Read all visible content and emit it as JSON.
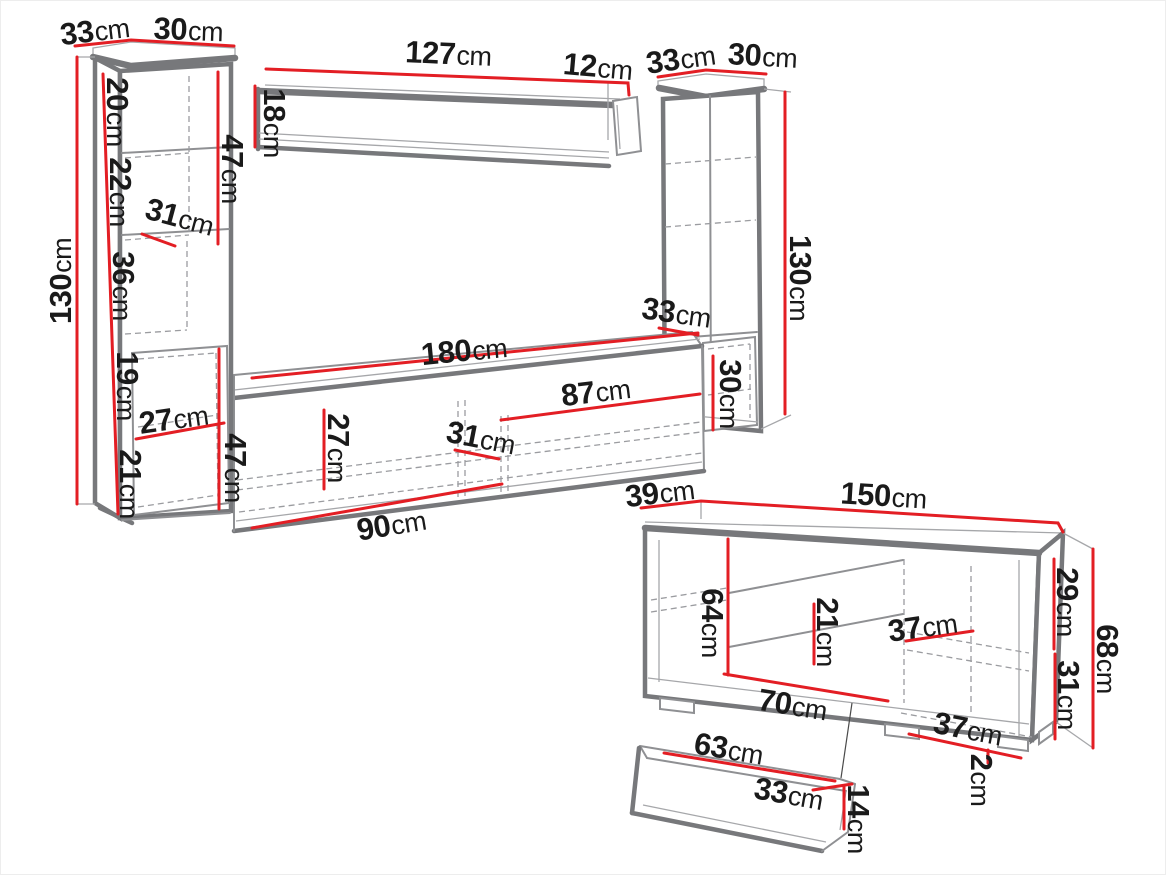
{
  "colors": {
    "accent_red": "#e31e24",
    "outline_gray": "#77787b",
    "text": "#1a1a1a",
    "background": "#ffffff"
  },
  "dims": {
    "lc_depth": {
      "v": "33",
      "u": "cm"
    },
    "lc_width": {
      "v": "30",
      "u": "cm"
    },
    "lc_height": {
      "v": "130",
      "u": "cm"
    },
    "lc_sec1": {
      "v": "20",
      "u": "cm"
    },
    "lc_sec2": {
      "v": "22",
      "u": "cm"
    },
    "lc_sec3": {
      "v": "36",
      "u": "cm"
    },
    "lc_sec4": {
      "v": "19",
      "u": "cm"
    },
    "lc_sec5": {
      "v": "21",
      "u": "cm"
    },
    "lc_door": {
      "v": "47",
      "u": "cm"
    },
    "lc_inner_width": {
      "v": "31",
      "u": "cm"
    },
    "lc_niche": {
      "v": "27",
      "u": "cm"
    },
    "ws_length": {
      "v": "127",
      "u": "cm"
    },
    "ws_end": {
      "v": "12",
      "u": "cm"
    },
    "ws_height": {
      "v": "18",
      "u": "cm"
    },
    "rc_depth": {
      "v": "33",
      "u": "cm"
    },
    "rc_width": {
      "v": "30",
      "u": "cm"
    },
    "rc_height": {
      "v": "130",
      "u": "cm"
    },
    "rc_niche_w": {
      "v": "33",
      "u": "cm"
    },
    "rc_niche_h": {
      "v": "30",
      "u": "cm"
    },
    "tv_length": {
      "v": "180",
      "u": "cm"
    },
    "tv_right": {
      "v": "87",
      "u": "cm"
    },
    "tv_inner_h": {
      "v": "27",
      "u": "cm"
    },
    "tv_inner_w": {
      "v": "31",
      "u": "cm"
    },
    "tv_left": {
      "v": "90",
      "u": "cm"
    },
    "tv_height": {
      "v": "47",
      "u": "cm"
    },
    "sb_depth": {
      "v": "39",
      "u": "cm"
    },
    "sb_width": {
      "v": "150",
      "u": "cm"
    },
    "sb_top_h": {
      "v": "29",
      "u": "cm"
    },
    "sb_bottom_h": {
      "v": "31",
      "u": "cm"
    },
    "sb_height": {
      "v": "68",
      "u": "cm"
    },
    "sb_door_h": {
      "v": "64",
      "u": "cm"
    },
    "sb_drawer_h": {
      "v": "21",
      "u": "cm"
    },
    "sb_shelf_d_top": {
      "v": "37",
      "u": "cm"
    },
    "sb_bottom_w": {
      "v": "70",
      "u": "cm"
    },
    "sb_shelf_d_bot": {
      "v": "37",
      "u": "cm"
    },
    "sb_foot_h": {
      "v": "2",
      "u": "cm"
    },
    "dr_width": {
      "v": "63",
      "u": "cm"
    },
    "dr_depth": {
      "v": "33",
      "u": "cm"
    },
    "dr_height": {
      "v": "14",
      "u": "cm"
    }
  }
}
